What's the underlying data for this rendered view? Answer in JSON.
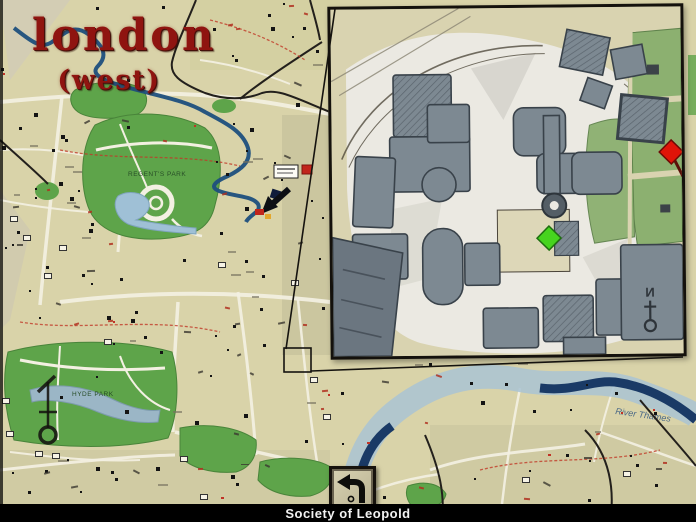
{
  "title": {
    "main": "london",
    "sub": "(west)"
  },
  "footer": {
    "location_label": "Society of Leopold"
  },
  "buttons": {
    "back": "back-arrow"
  },
  "map": {
    "labels": {
      "regents_park": "REGENT'S PARK",
      "hyde_park": "HYDE PARK",
      "river_thames": "River Thames",
      "compass_north": "N"
    },
    "markers": {
      "destination_red": "#e01408",
      "current_green": "#46d41e"
    },
    "colors": {
      "paper": "#d9d3a9",
      "park_green": "#5ea44a",
      "water_dark": "#1d4f7d",
      "water_light": "#a9c3d4",
      "title_red": "#8f1410",
      "inset_building": "#7d8992",
      "inset_paper": "#ebe9e2"
    }
  },
  "inset": {
    "compass_north": "N"
  }
}
